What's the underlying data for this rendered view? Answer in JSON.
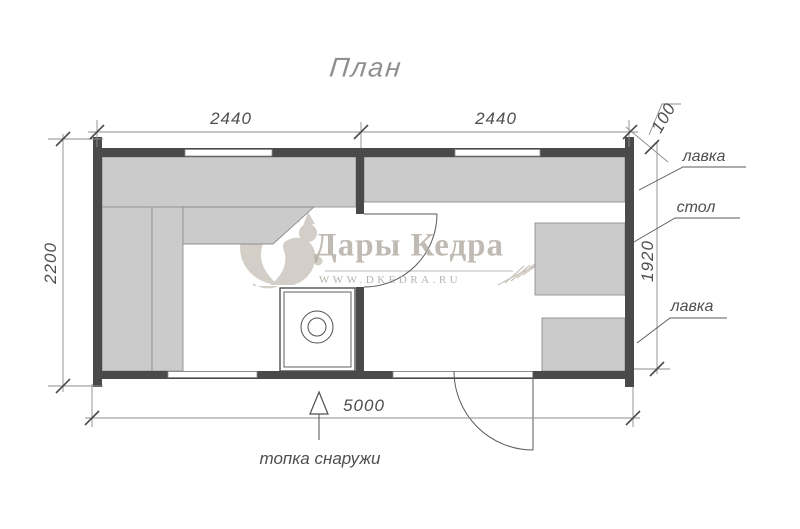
{
  "title": "План",
  "dimensions": {
    "room_left_width": "2440",
    "room_right_width": "2440",
    "wall_thickness": "100",
    "building_depth": "2200",
    "room_right_depth": "1920",
    "building_length": "5000"
  },
  "labels": {
    "bench_top_right": "лавка",
    "table": "стол",
    "bench_bottom_right": "лавка",
    "furnace_note": "топка снаружи"
  },
  "watermark": {
    "brand": "Дары Кедра",
    "website": "WWW.DKEDRA.RU"
  },
  "colors": {
    "wall": "#4a4a4a",
    "bench_fill": "#cbcbcb",
    "bench_stroke": "#8f8f8f",
    "dim_line": "#8c8c8c",
    "dim_text": "#4f4f4f",
    "watermark": "#b1aaa2",
    "title_text": "#8f8f8f"
  }
}
